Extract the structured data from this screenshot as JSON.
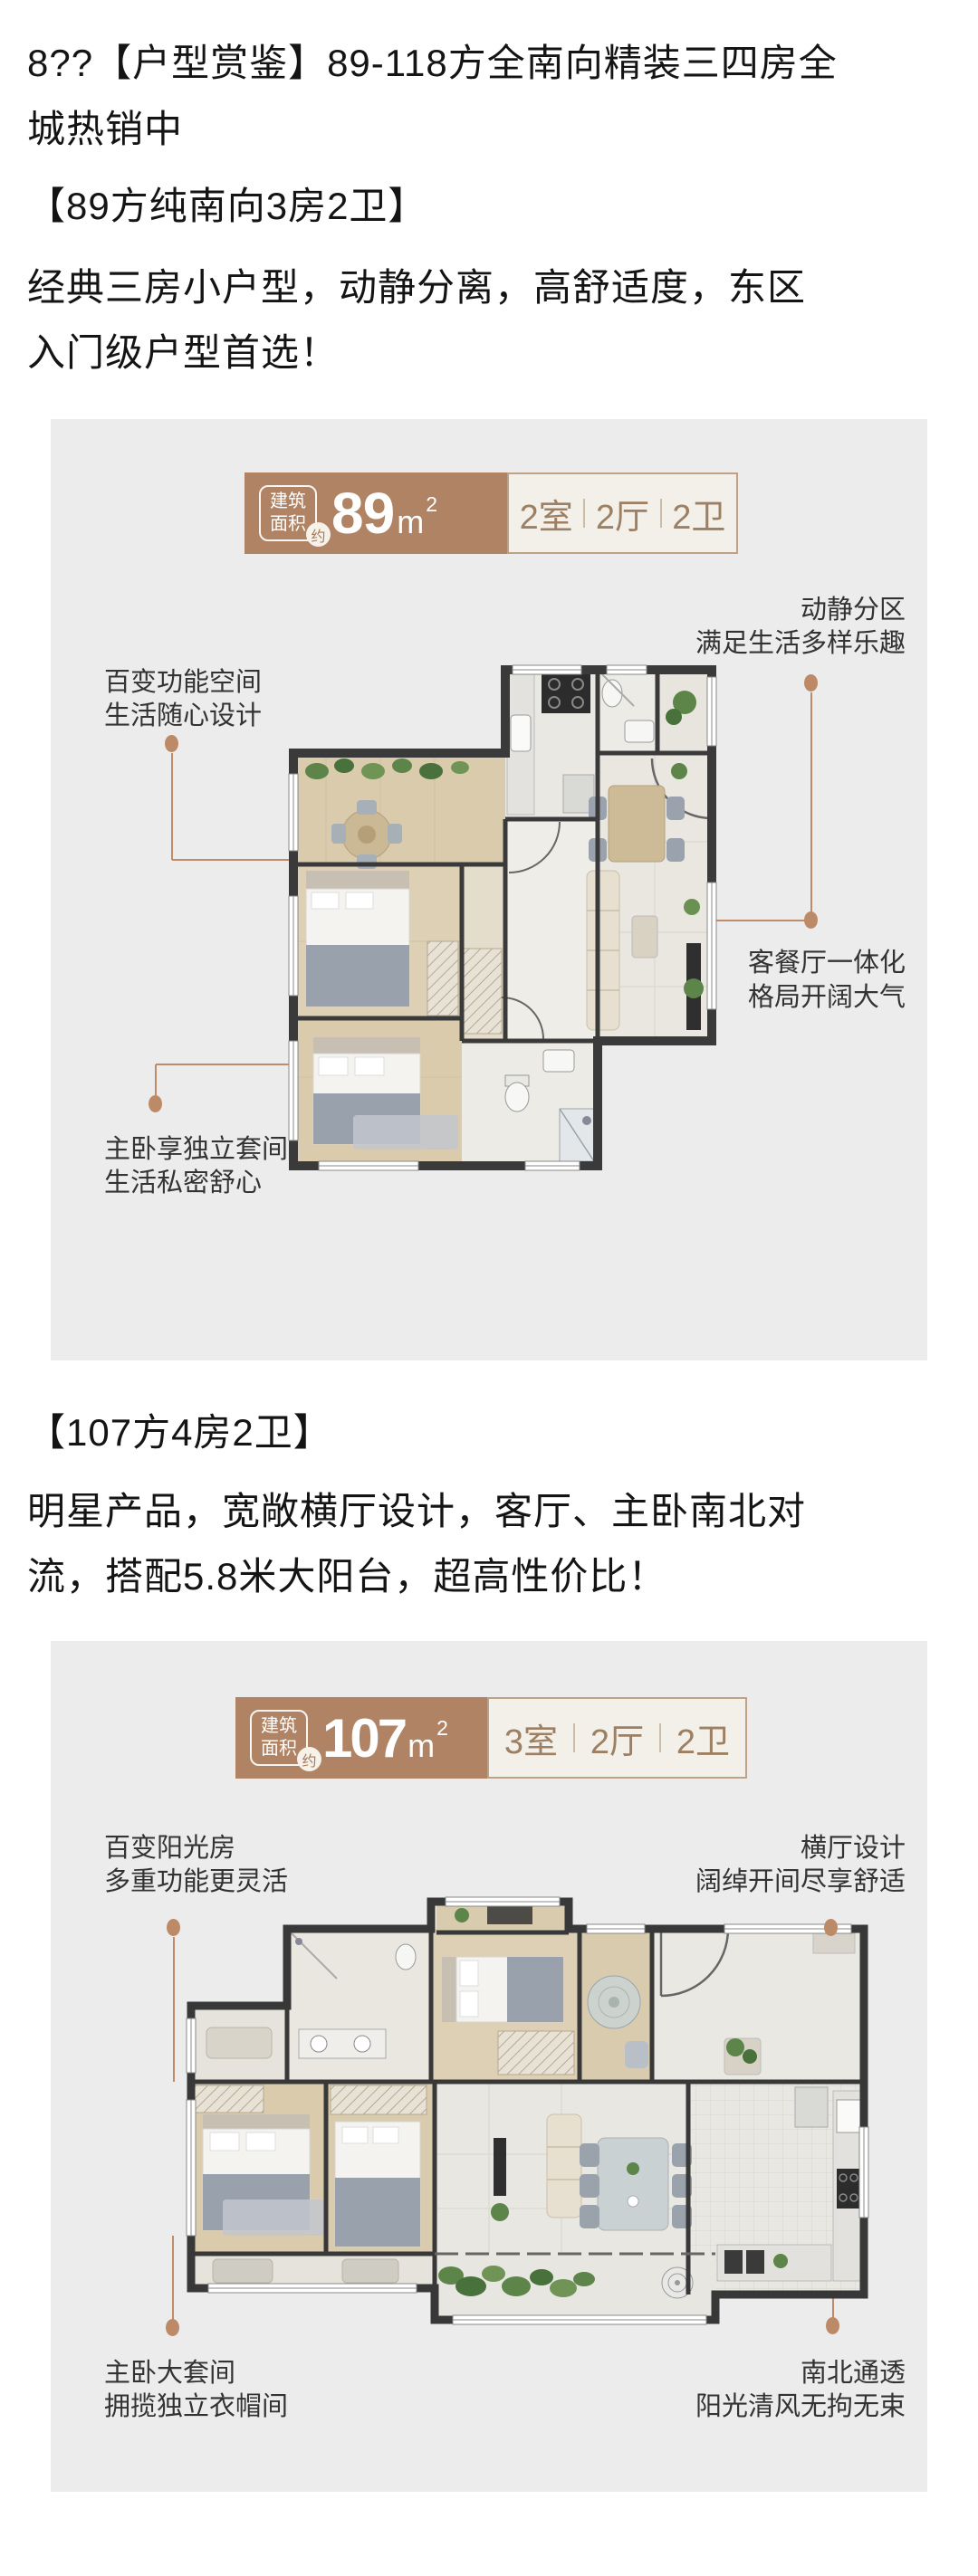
{
  "colors": {
    "badge_brown": "#af8363",
    "badge_light_bg": "#f2f0e9",
    "badge_border": "#bfa285",
    "badge_text": "#9d8063",
    "leader_line": "#c08b68",
    "image_block_bg": "#ececec",
    "heading_text": "#141414",
    "annotation_text": "#333333",
    "wall": "#3a3a3a",
    "wood_floor": "#dacbad",
    "tile_floor": "#e9e7e0",
    "plant_green": "#5d8549"
  },
  "article": {
    "heading_line1": "8??【户型赏鉴】89-118方全南向精装三四房全",
    "heading_line2": "城热销中"
  },
  "s1": {
    "title": "【89方纯南向3房2卫】",
    "desc_line1": "经典三房小户型，动静分离，高舒适度，东区",
    "desc_line2": "入门级户型首选！",
    "badge": {
      "label1": "建筑",
      "label2": "面积",
      "approx": "约",
      "area": "89",
      "unit": "m",
      "sup": "2",
      "spec": [
        "2室",
        "2厅",
        "2卫"
      ]
    },
    "ann": {
      "tl": [
        "百变功能空间",
        "生活随心设计"
      ],
      "tr": [
        "动静分区",
        "满足生活多样乐趣"
      ],
      "br": [
        "客餐厅一体化",
        "格局开阔大气"
      ],
      "bl": [
        "主卧享独立套间",
        "生活私密舒心"
      ]
    }
  },
  "s2": {
    "title": "【107方4房2卫】",
    "desc_line1": "明星产品，宽敞横厅设计，客厅、主卧南北对",
    "desc_line2": "流，搭配5.8米大阳台，超高性价比！",
    "badge": {
      "label1": "建筑",
      "label2": "面积",
      "approx": "约",
      "area": "107",
      "unit": "m",
      "sup": "2",
      "spec": [
        "3室",
        "2厅",
        "2卫"
      ]
    },
    "ann": {
      "tl": [
        "百变阳光房",
        "多重功能更灵活"
      ],
      "tr": [
        "横厅设计",
        "阔绰开间尽享舒适"
      ],
      "bl": [
        "主卧大套间",
        "拥揽独立衣帽间"
      ],
      "br": [
        "南北通透",
        "阳光清风无拘无束"
      ]
    }
  }
}
